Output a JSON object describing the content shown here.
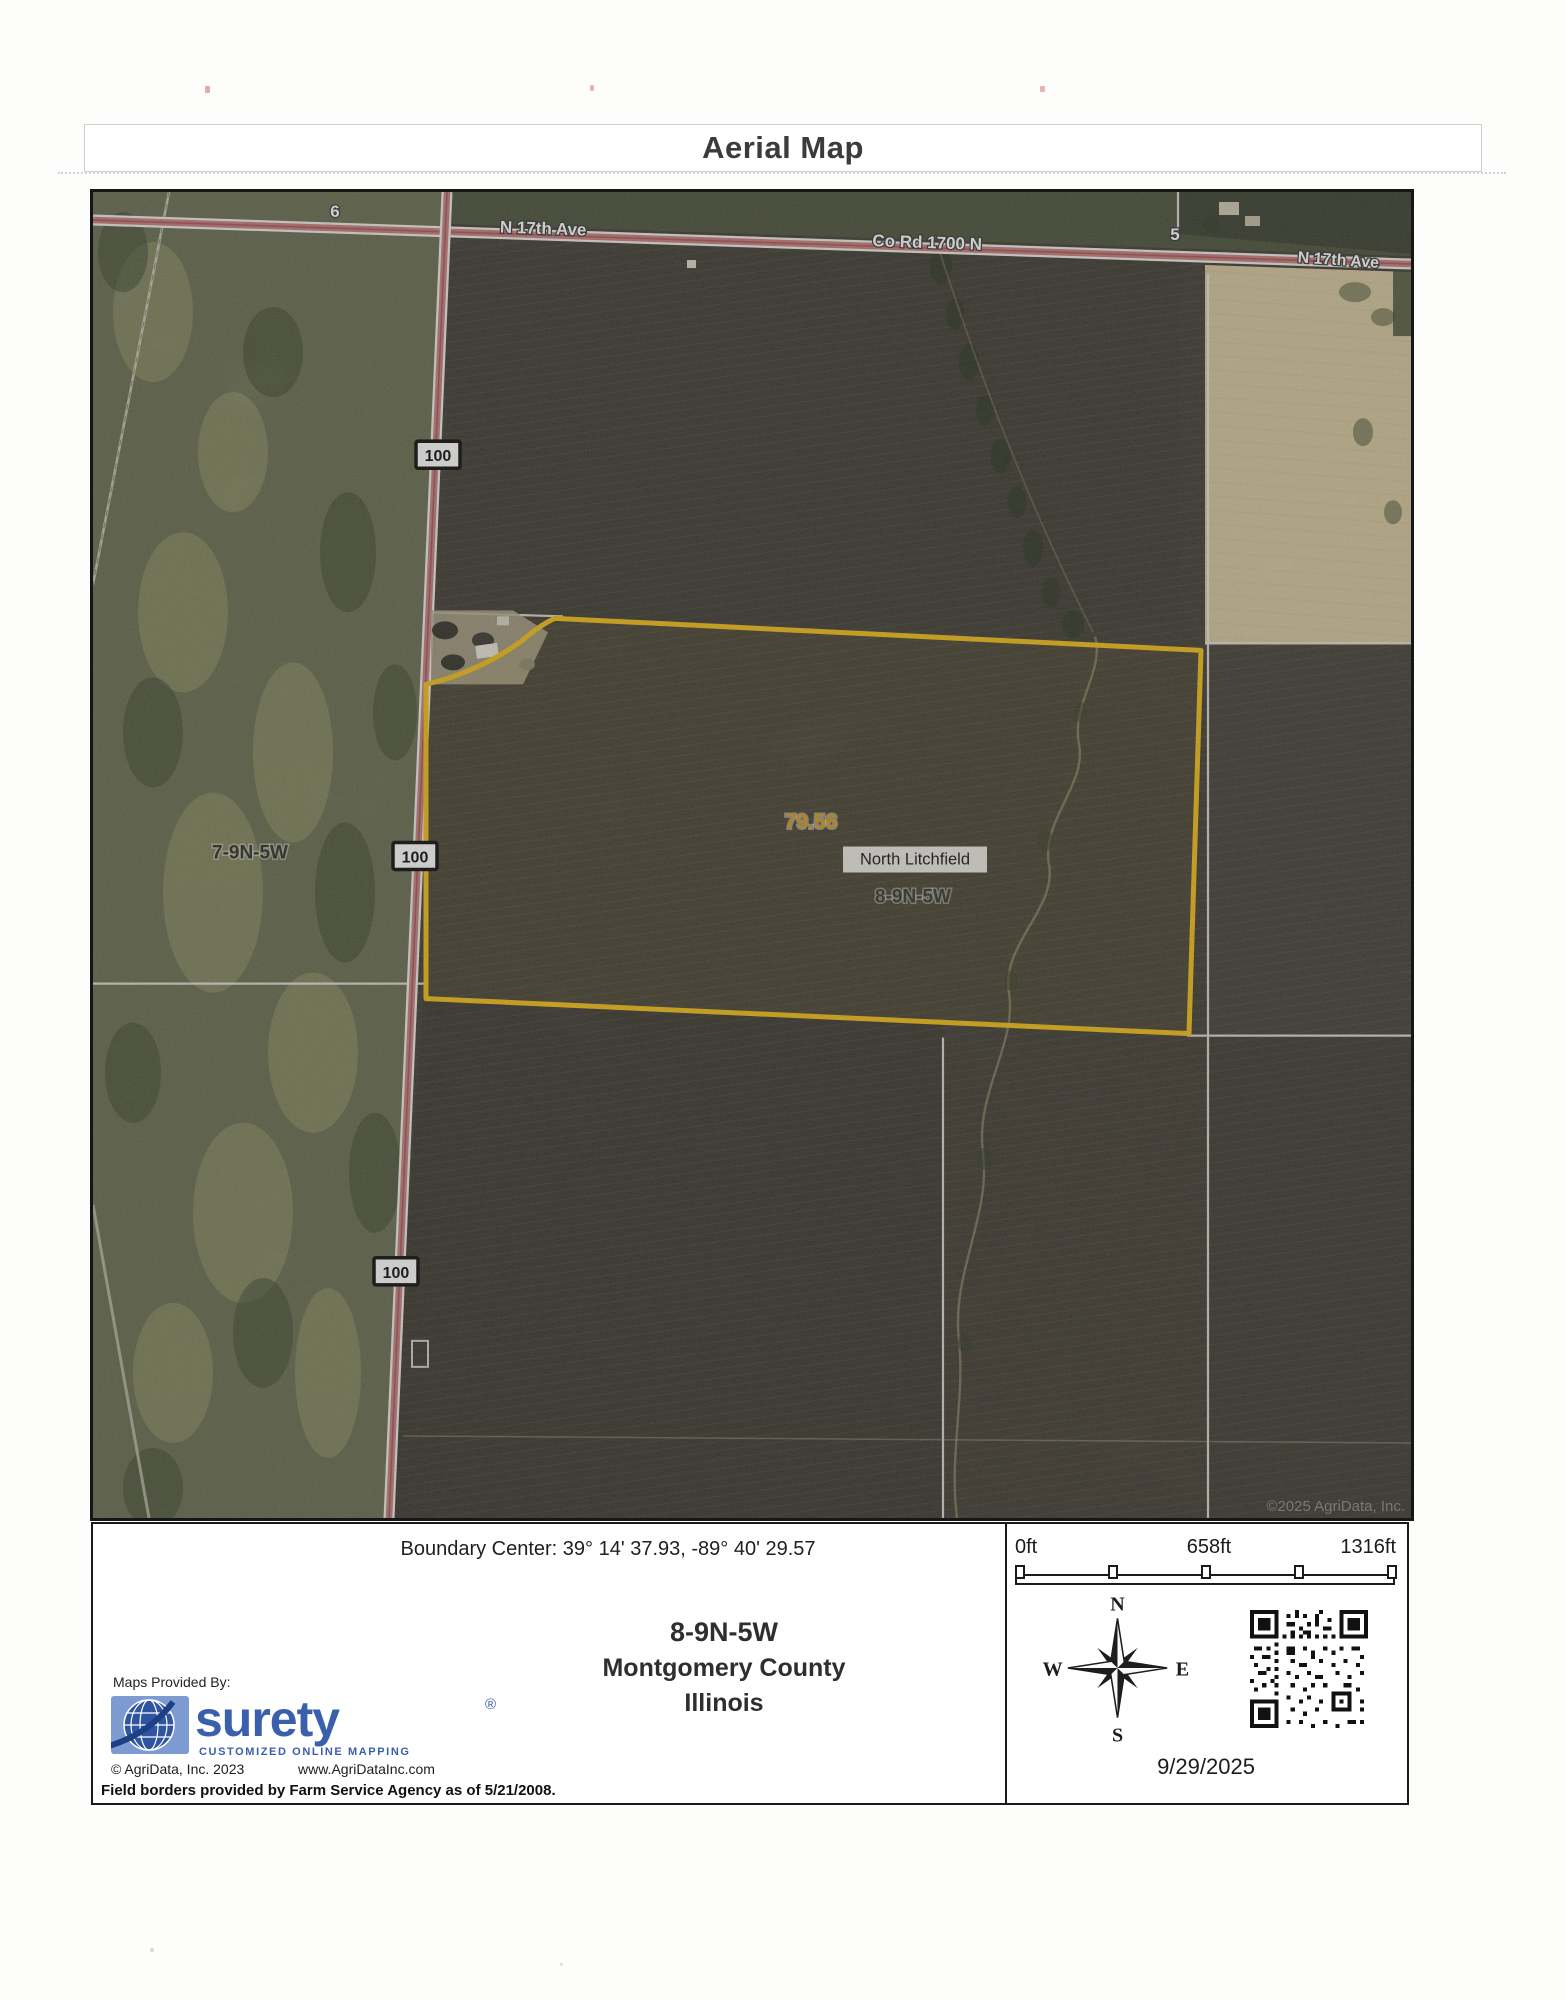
{
  "title": "Aerial Map",
  "map": {
    "labels": {
      "n17th_ave_left": "N 17th Ave",
      "co_rd_1700_n": "Co Rd 1700 N",
      "section_5": "5",
      "n17th_ave_right": "N 17th Ave",
      "section_6": "6",
      "route_100": "100",
      "section_west": "7-9N-5W",
      "acres": "79.56",
      "area_name": "North Litchfield",
      "section_main": "8-9N-5W",
      "watermark": "©2025 AgriData, Inc."
    }
  },
  "footer": {
    "boundary_center": "Boundary Center: 39° 14' 37.93, -89° 40' 29.57",
    "section": "8-9N-5W",
    "county": "Montgomery County",
    "state": "Illinois",
    "scale": {
      "zero": "0ft",
      "mid": "658ft",
      "full": "1316ft"
    },
    "compass": {
      "north": "N",
      "south": "S",
      "east": "E",
      "west": "W"
    },
    "date": "9/29/2025",
    "provider": {
      "heading": "Maps Provided By:",
      "brand": "surety",
      "registered": "®",
      "tagline": "CUSTOMIZED ONLINE MAPPING",
      "copyright": "© AgriData, Inc. 2023",
      "website": "www.AgriDataInc.com"
    },
    "disclaimer": "Field borders provided by Farm Service Agency as of 5/21/2008."
  },
  "colors": {
    "boundary_yellow": "#F2C01D",
    "acres_text": "#DB9E1E",
    "brand_blue": "#3A5FAD"
  }
}
